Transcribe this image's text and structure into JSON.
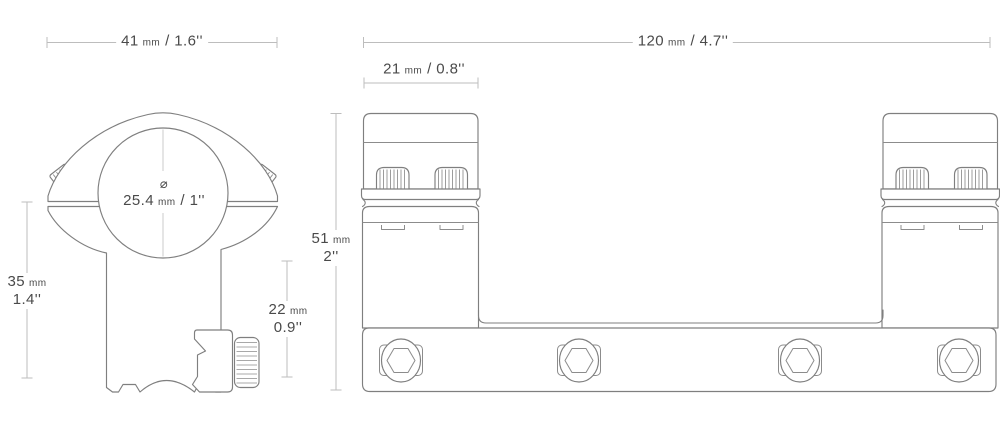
{
  "colors": {
    "background": "#ffffff",
    "outline": "#7f7f7f",
    "detail": "#8c8c8c",
    "dim_line": "#bdbdbd",
    "text": "#4a4a4a"
  },
  "front_view": {
    "width_label": {
      "value": "41",
      "unit": "mm",
      "inches": "/ 1.6''"
    },
    "height_label": {
      "value": "35",
      "unit": "mm",
      "inches": "1.4''"
    },
    "saddle_label": {
      "value": "22",
      "unit": "mm",
      "inches": "0.9''"
    },
    "bore_label": {
      "symbol": "⌀",
      "value": "25.4",
      "unit": "mm",
      "inches": "/ 1''"
    }
  },
  "side_view": {
    "length_label": {
      "value": "120",
      "unit": "mm",
      "inches": "/ 4.7''"
    },
    "ring_width_label": {
      "value": "21",
      "unit": "mm",
      "inches": "/ 0.8''"
    },
    "height_label": {
      "value": "51",
      "unit": "mm",
      "inches": "2''"
    }
  }
}
